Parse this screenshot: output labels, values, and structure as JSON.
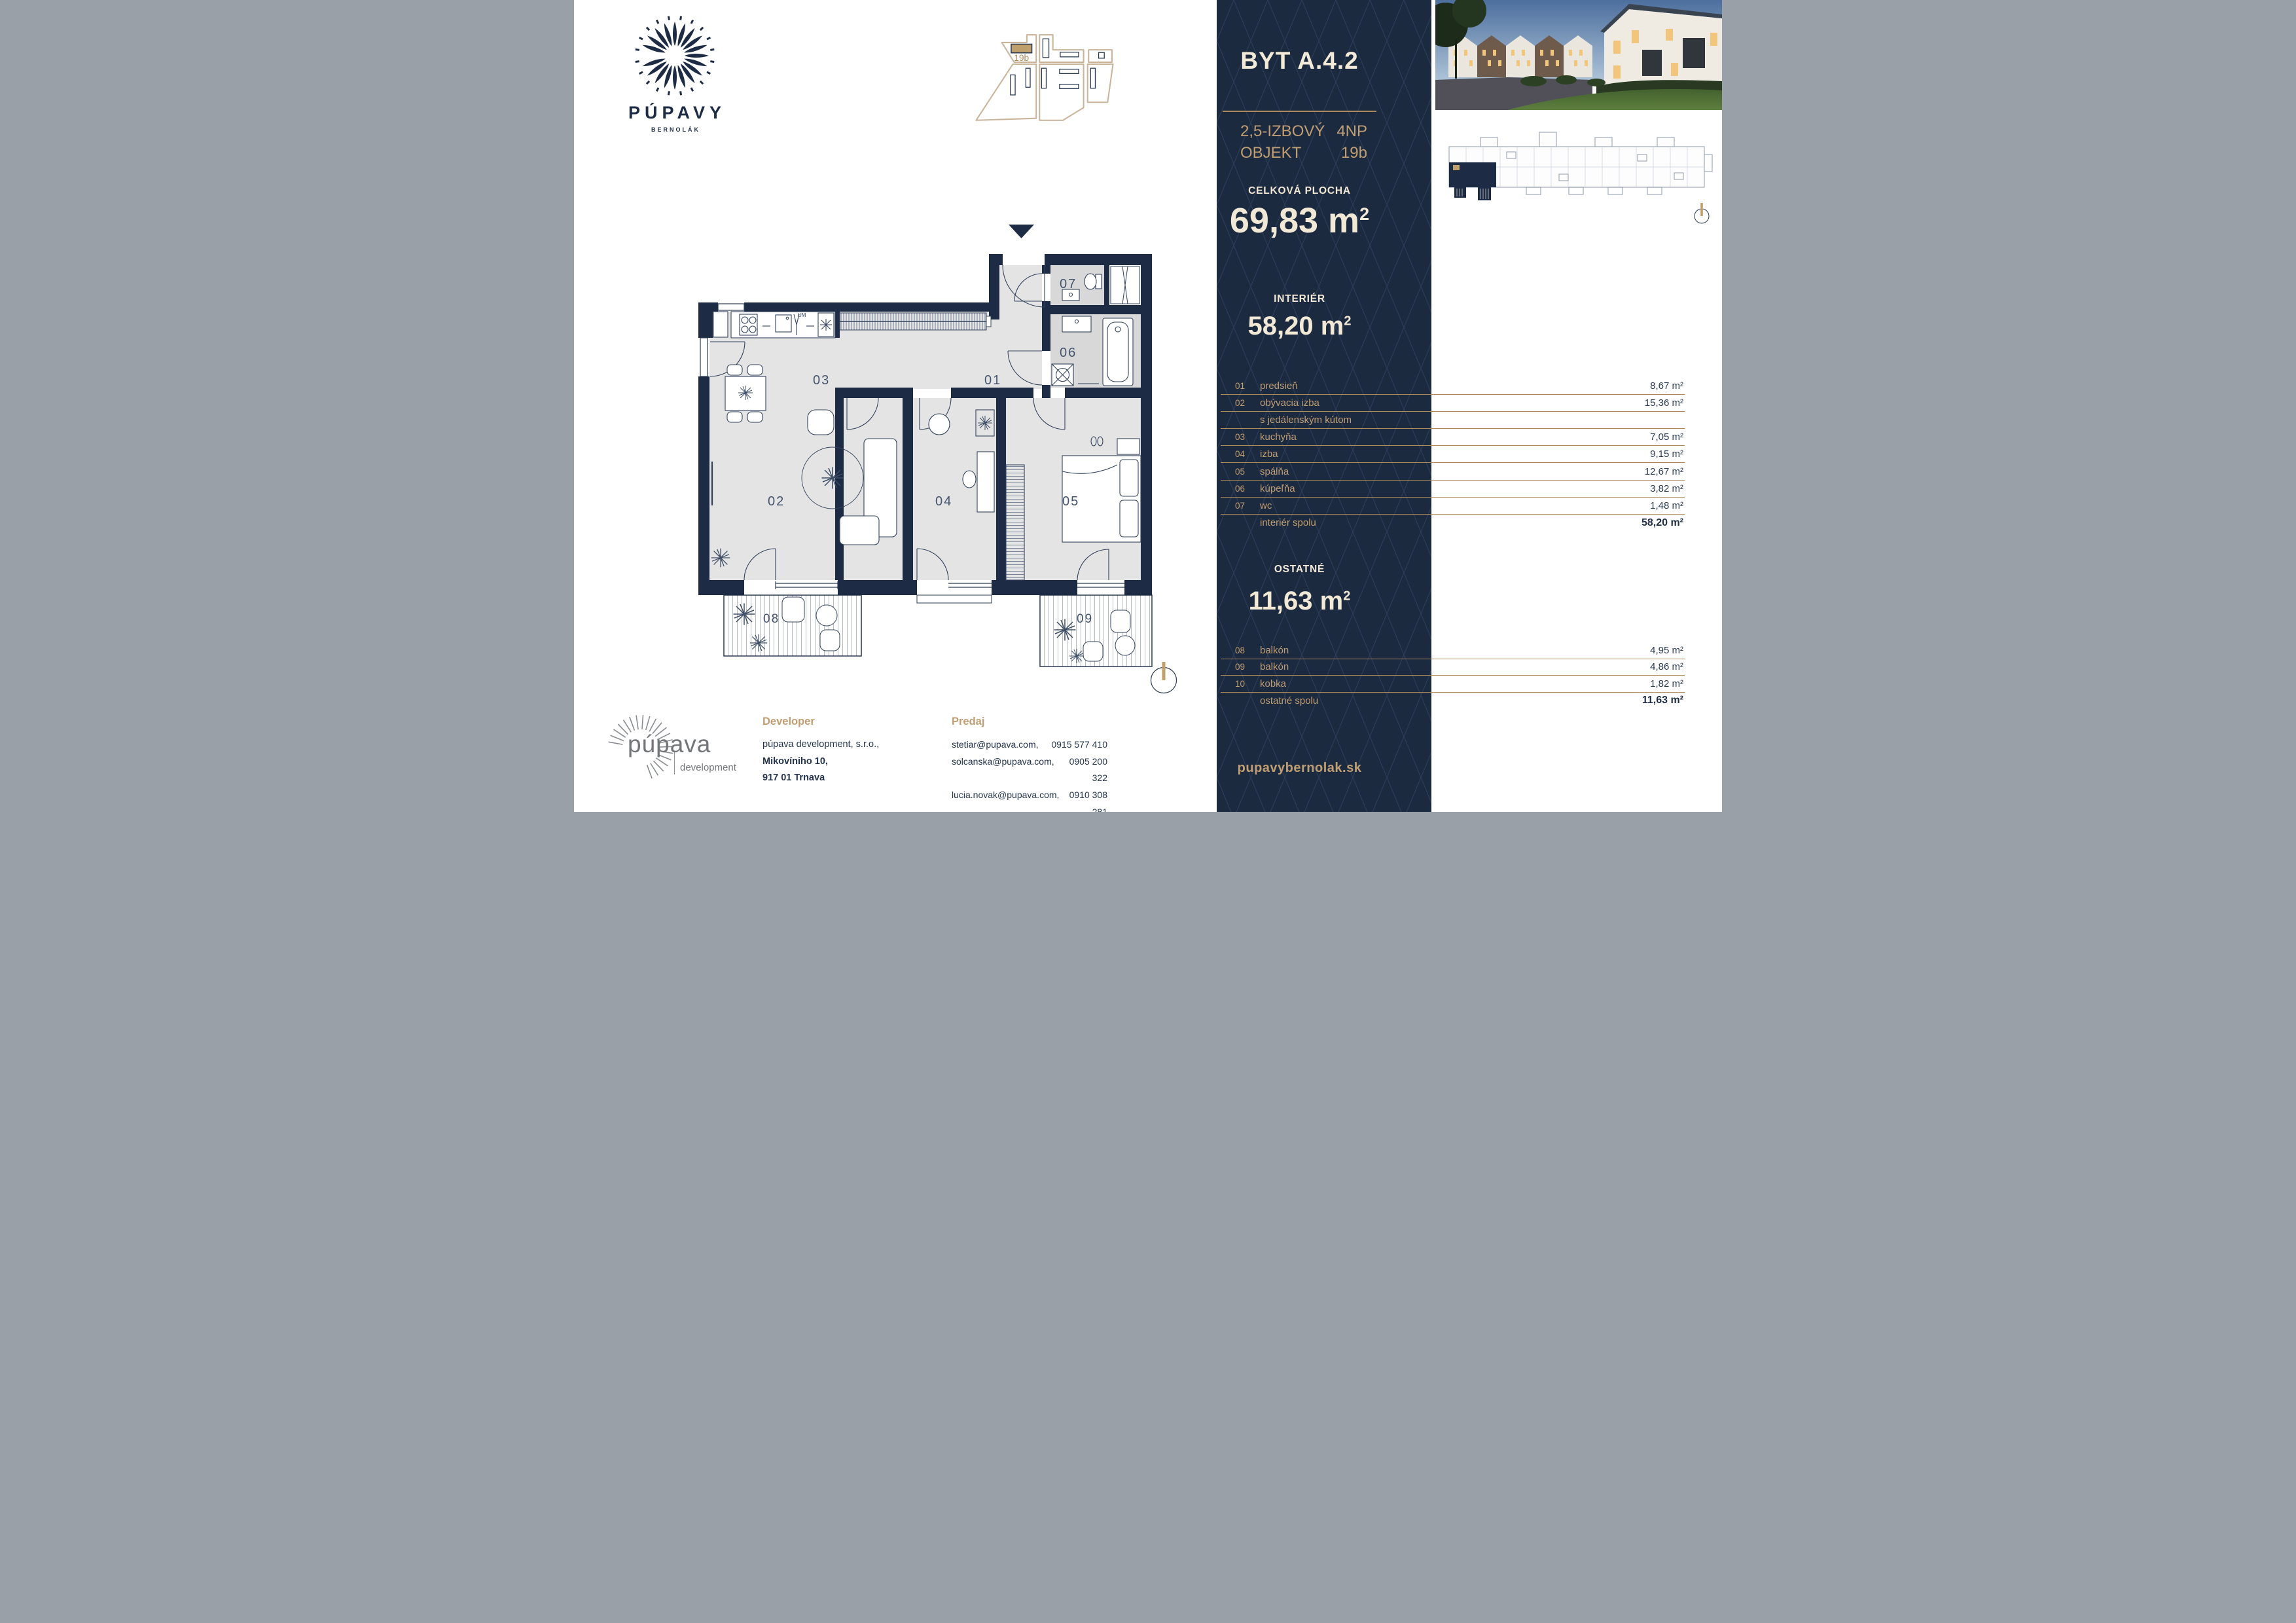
{
  "colors": {
    "navy": "#1c2a40",
    "tan": "#c19d72",
    "cream": "#f2e8d6",
    "rule_line": "#ad8a5c",
    "highlight": "#bfa06d"
  },
  "brand": {
    "name": "PÚPAVY",
    "subtitle": "BERNOLÁK"
  },
  "site_plan": {
    "highlight_label": "19b"
  },
  "header": {
    "title": "BYT A.4.2",
    "rooms_type": "2,5-IZBOVÝ",
    "object_label": "OBJEKT",
    "floor": "4NP",
    "building": "19b"
  },
  "m2": {
    "base": "m",
    "sup": "2"
  },
  "total_area": {
    "label": "CELKOVÁ PLOCHA",
    "value": "69,83"
  },
  "interior": {
    "label": "INTERIÉR",
    "value": "58,20"
  },
  "other": {
    "label": "OSTATNÉ",
    "value": "11,63"
  },
  "interior_rooms": [
    {
      "num": "01",
      "name": "predsieň",
      "area": "8,67 m²",
      "rule": true
    },
    {
      "num": "02",
      "name": "obývacia izba",
      "area": "15,36 m²",
      "rule": true
    },
    {
      "num": "",
      "name": "s jedálenským kútom",
      "area": "",
      "rule": true
    },
    {
      "num": "03",
      "name": "kuchyňa",
      "area": "7,05 m²",
      "rule": true
    },
    {
      "num": "04",
      "name": "izba",
      "area": "9,15 m²",
      "rule": true
    },
    {
      "num": "05",
      "name": "spálňa",
      "area": "12,67 m²",
      "rule": true
    },
    {
      "num": "06",
      "name": "kúpeľňa",
      "area": "3,82 m²",
      "rule": true
    },
    {
      "num": "07",
      "name": "wc",
      "area": "1,48 m²",
      "rule": true
    },
    {
      "num": "",
      "name": "interiér spolu",
      "area": "58,20 m²",
      "total": true
    }
  ],
  "other_rooms": [
    {
      "num": "08",
      "name": "balkón",
      "area": "4,95 m²",
      "rule": true
    },
    {
      "num": "09",
      "name": "balkón",
      "area": "4,86 m²",
      "rule": true
    },
    {
      "num": "10",
      "name": "kobka",
      "area": "1,82 m²",
      "rule": true
    },
    {
      "num": "",
      "name": "ostatné spolu",
      "area": "11,63 m²",
      "total": true
    }
  ],
  "website": "pupavybernolak.sk",
  "developer": {
    "heading": "Developer",
    "logo_main": "púpava",
    "logo_sub": "development",
    "company": "púpava development, s.r.o.,",
    "street": "Mikovíniho 10,",
    "city": "917 01 Trnava"
  },
  "sales": {
    "heading": "Predaj",
    "contacts": [
      {
        "email": "stetiar@pupava.com,",
        "phone": "0915 577 410"
      },
      {
        "email": "solcanska@pupava.com,",
        "phone": "0905 200 322"
      },
      {
        "email": "lucia.novak@pupava.com,",
        "phone": "0910 308 281"
      }
    ]
  },
  "plan": {
    "r01": "01",
    "r02": "02",
    "r03": "03",
    "r04": "04",
    "r05": "05",
    "r06": "06",
    "r07": "07",
    "r08": "08",
    "r09": "09",
    "um": "UM"
  }
}
